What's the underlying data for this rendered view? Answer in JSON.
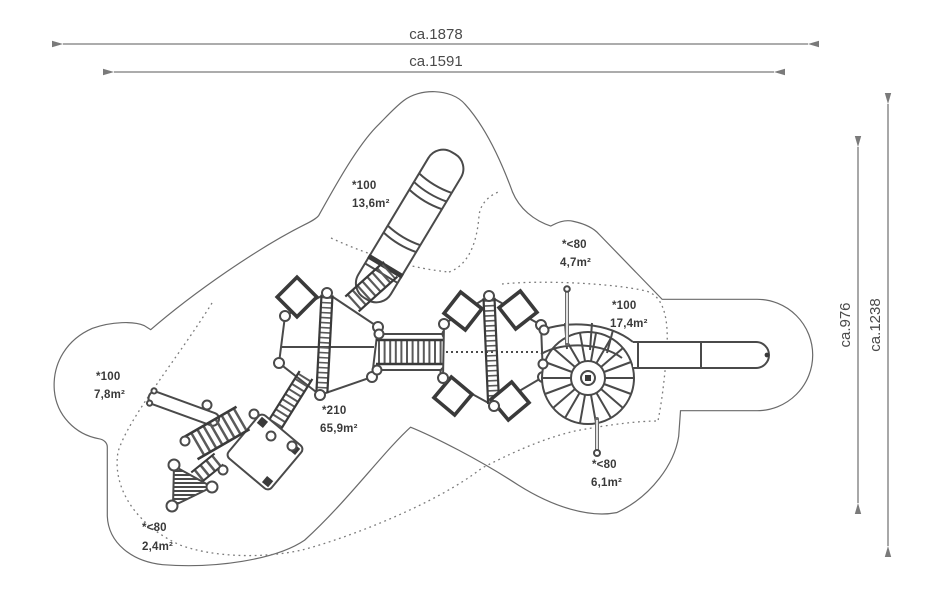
{
  "drawing": {
    "kind": "playground equipment plan view",
    "dimensions": {
      "top_outer": "ca.1878",
      "top_inner": "ca.1591",
      "right_inner": "ca.976",
      "right_outer": "ca.1238"
    },
    "zones": [
      {
        "id": "tube-slide-zone",
        "code": "*100",
        "area": "13,6m²"
      },
      {
        "id": "upper-right-zone",
        "code": "*<80",
        "area": "4,7m²"
      },
      {
        "id": "spiral-slide-zone",
        "code": "*100",
        "area": "17,4m²"
      },
      {
        "id": "left-slide-zone",
        "code": "*100",
        "area": "7,8m²"
      },
      {
        "id": "main-structure-zone",
        "code": "*210",
        "area": "65,9m²"
      },
      {
        "id": "lower-pole-zone",
        "code": "*<80",
        "area": "6,1m²"
      },
      {
        "id": "lower-left-zone",
        "code": "*<80",
        "area": "2,4m²"
      }
    ],
    "colors": {
      "outline": "#6a6a6a",
      "structure": "#4a4a4a",
      "structure_dark": "#3a3a3a",
      "dimension": "#7a7a7a",
      "text": "#3a3a3a",
      "background": "#ffffff"
    }
  }
}
